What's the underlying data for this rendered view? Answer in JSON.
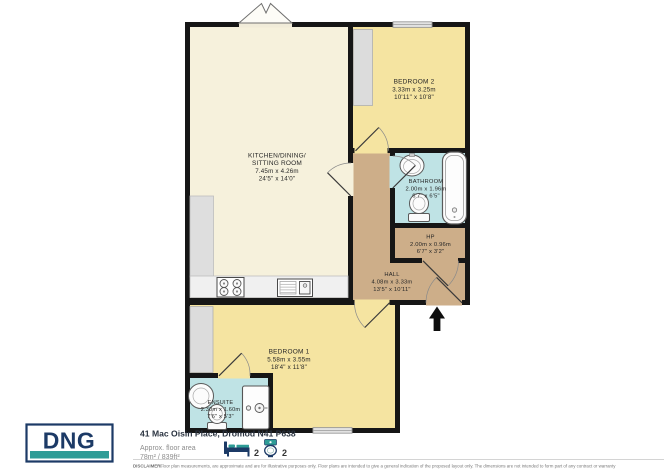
{
  "plan": {
    "logo": "DNG",
    "address": "41 Mac Oisin Place, Dromod N41 P638",
    "approx_label": "Approx. floor area",
    "approx_value": "78m² / 839ft²",
    "beds": "2",
    "baths": "2",
    "disclaimer_label": "DISCLAIMER:",
    "disclaimer": "Floor plan measurements, are approximate and are for illustrative purposes only. Floor plans are intended to give a general indication of the proposed layout only. The dimensions are not intended to form part of any contract or warranty",
    "colors": {
      "wall": "#161616",
      "living": "#F6F1DC",
      "bedroom": "#F5E4A1",
      "bathroom": "#BFE3E5",
      "hall": "#CDAE89",
      "brand_navy": "#1C3A66",
      "brand_teal": "#2E9C96"
    },
    "rooms": {
      "kitchen": {
        "name1": "KITCHEN/DINING/",
        "name2": "SITTING ROOM",
        "metric": "7.45m  x 4.26m",
        "imperial": "24'5\"  x 14'0\""
      },
      "bedroom2": {
        "name": "BEDROOM 2",
        "metric": "3.33m  x 3.25m",
        "imperial": "10'11\"  x 10'8\""
      },
      "bathroom": {
        "name": "BATHROOM",
        "metric": "2.00m  x 1.96m",
        "imperial": "6'7\"  x 6'5\""
      },
      "hp": {
        "name": "HP",
        "metric": "2.00m  x 0.96m",
        "imperial": "6'7\"  x 3'2\""
      },
      "hall": {
        "name": "HALL",
        "metric": "4.08m  x 3.33m",
        "imperial": "13'5\"  x 10'11\""
      },
      "bedroom1": {
        "name": "BEDROOM 1",
        "metric": "5.58m  x 3.55m",
        "imperial": "18'4\"  x 11'8\""
      },
      "ensuite": {
        "name": "ENSUITE",
        "metric": "2.30m  x 1.60m",
        "imperial": "7'6\"  x 5'3\""
      }
    }
  }
}
